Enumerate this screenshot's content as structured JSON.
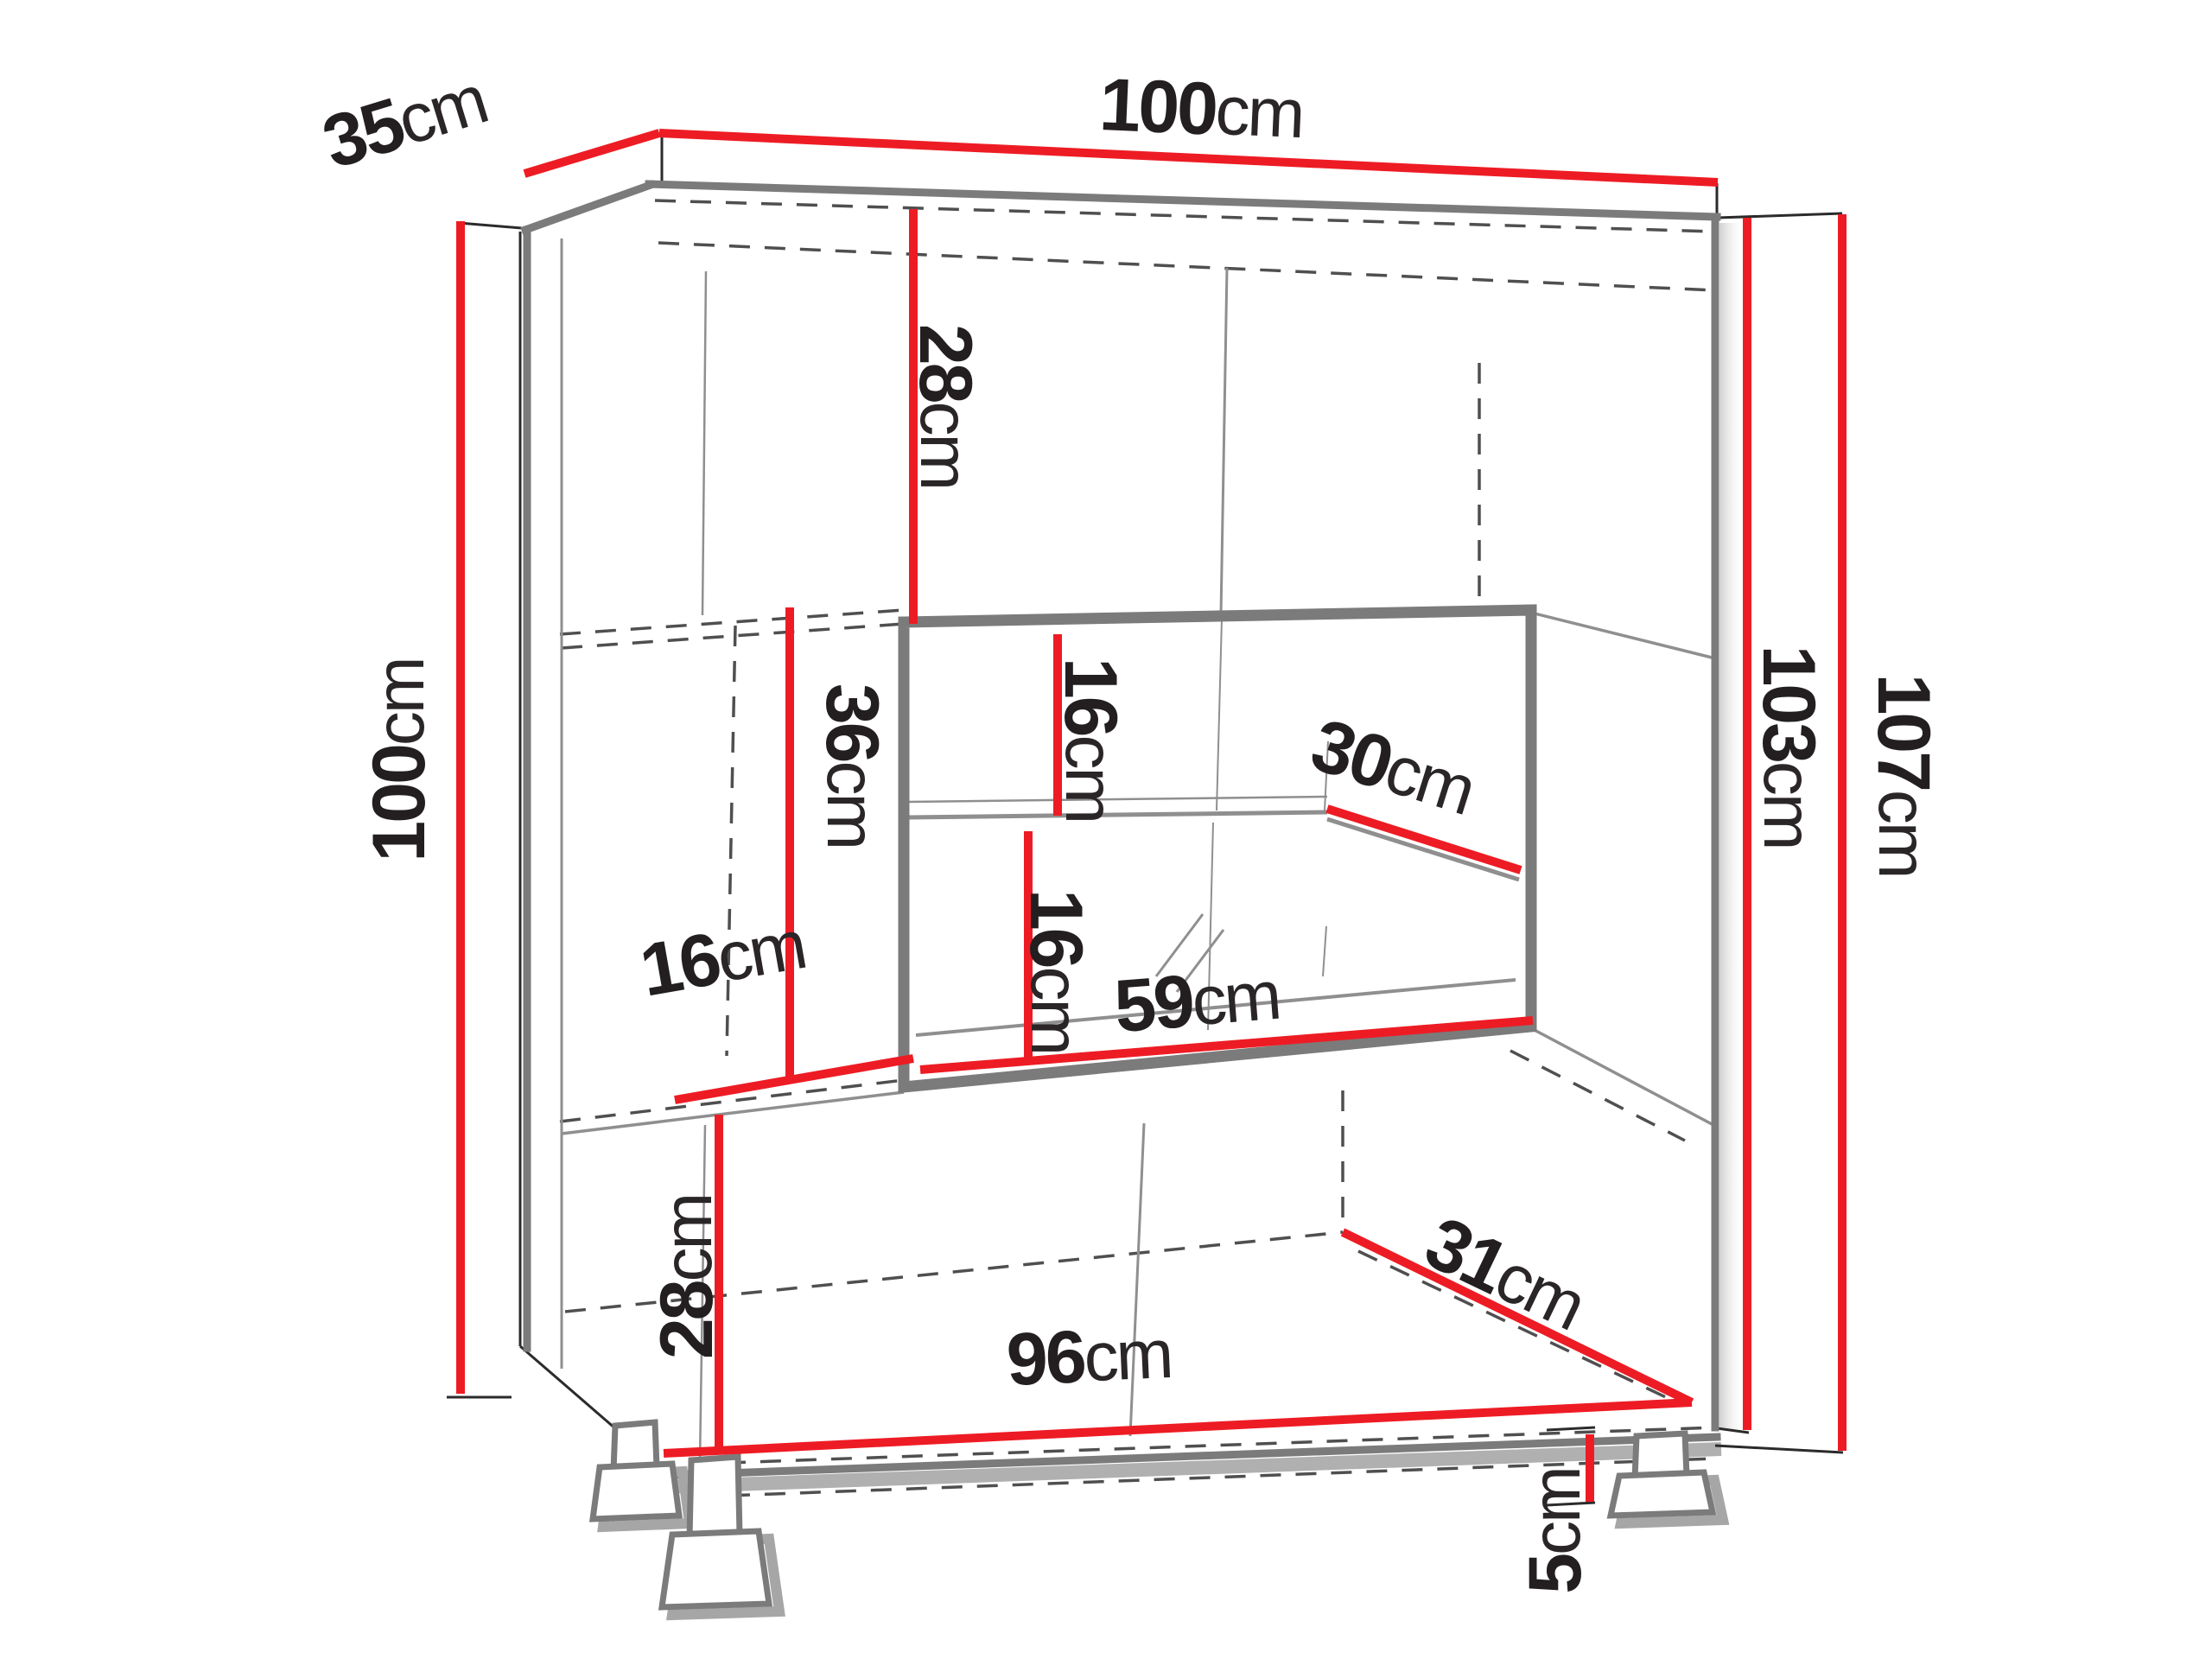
{
  "title": "Cabinet dimension diagram",
  "colors": {
    "dimension_line": "#ed1c24",
    "cabinet_outline": "#7b7b7b",
    "label_text": "#231f20",
    "background": "#ffffff"
  },
  "dimensions": {
    "depth_top": {
      "value": "35",
      "unit": "cm"
    },
    "width_top": {
      "value": "100",
      "unit": "cm"
    },
    "height_left": {
      "value": "100",
      "unit": "cm"
    },
    "height_body_right": {
      "value": "103",
      "unit": "cm"
    },
    "height_total_right": {
      "value": "107",
      "unit": "cm"
    },
    "top_section_height": {
      "value": "28",
      "unit": "cm"
    },
    "niche_upper_gap": {
      "value": "16",
      "unit": "cm"
    },
    "glass_shelf_depth": {
      "value": "30",
      "unit": "cm"
    },
    "middle_section_height": {
      "value": "36",
      "unit": "cm"
    },
    "niche_lower_gap": {
      "value": "16",
      "unit": "cm"
    },
    "niche_width": {
      "value": "59",
      "unit": "cm"
    },
    "left_section_width": {
      "value": "16",
      "unit": "cm"
    },
    "bottom_section_height": {
      "value": "28",
      "unit": "cm"
    },
    "bottom_width": {
      "value": "96",
      "unit": "cm"
    },
    "bottom_depth": {
      "value": "31",
      "unit": "cm"
    },
    "feet_height": {
      "value": "5",
      "unit": "cm"
    }
  }
}
